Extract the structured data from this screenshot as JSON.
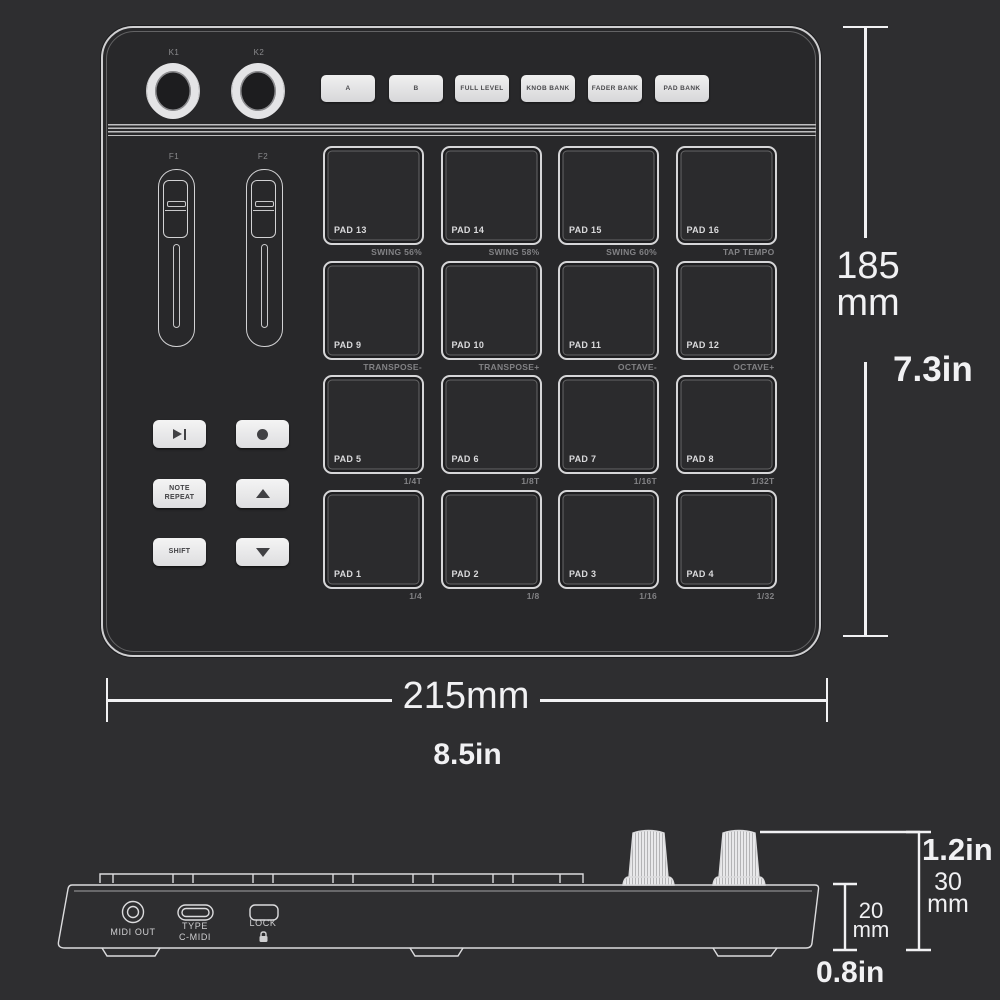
{
  "top_view": {
    "knobs": [
      {
        "label": "K1"
      },
      {
        "label": "K2"
      }
    ],
    "bank_buttons": [
      {
        "label": "A"
      },
      {
        "label": "B"
      },
      {
        "label": "FULL LEVEL"
      },
      {
        "label": "KNOB BANK"
      },
      {
        "label": "FADER BANK"
      },
      {
        "label": "PAD BANK"
      }
    ],
    "faders": [
      {
        "label": "F1"
      },
      {
        "label": "F2"
      }
    ],
    "transport": {
      "play_pause_icon": "play-pause",
      "record_icon": "record",
      "note_repeat_label": "NOTE REPEAT",
      "up_icon": "triangle-up",
      "shift_label": "SHIFT",
      "down_icon": "triangle-down"
    },
    "pads": [
      {
        "label": "PAD 13",
        "sub": "SWING 56%"
      },
      {
        "label": "PAD 14",
        "sub": "SWING 58%"
      },
      {
        "label": "PAD 15",
        "sub": "SWING 60%"
      },
      {
        "label": "PAD 16",
        "sub": "TAP TEMPO"
      },
      {
        "label": "PAD 9",
        "sub": "TRANSPOSE-"
      },
      {
        "label": "PAD 10",
        "sub": "TRANSPOSE+"
      },
      {
        "label": "PAD 11",
        "sub": "OCTAVE-"
      },
      {
        "label": "PAD 12",
        "sub": "OCTAVE+"
      },
      {
        "label": "PAD 5",
        "sub": "1/4T"
      },
      {
        "label": "PAD 6",
        "sub": "1/8T"
      },
      {
        "label": "PAD 7",
        "sub": "1/16T"
      },
      {
        "label": "PAD 8",
        "sub": "1/32T"
      },
      {
        "label": "PAD 1",
        "sub": "1/4"
      },
      {
        "label": "PAD 2",
        "sub": "1/8"
      },
      {
        "label": "PAD 3",
        "sub": "1/16"
      },
      {
        "label": "PAD 4",
        "sub": "1/32"
      }
    ]
  },
  "dimensions": {
    "height_metric_line1": "185",
    "height_metric_line2": "mm",
    "height_imperial": "7.3in",
    "width_metric": "215mm",
    "width_imperial": "8.5in"
  },
  "side_view": {
    "ports": {
      "midi_out_label": "MIDI OUT",
      "usb_label_line1": "TYPE",
      "usb_label_line2": "C-MIDI",
      "lock_label": "LOCK",
      "lock_icon": "padlock"
    },
    "dims": {
      "total_height_imperial": "1.2in",
      "total_height_metric_line1": "30",
      "total_height_metric_line2": "mm",
      "body_height_metric_line1": "20",
      "body_height_metric_line2": "mm",
      "body_height_imperial": "0.8in"
    }
  },
  "colors": {
    "background": "#2e2e30",
    "device_fill": "#28282a",
    "outline": "#d4d4d6",
    "dim_text": "#f1f1f3",
    "sub_text": "#858588",
    "button_fill": "#e6e6e8"
  }
}
